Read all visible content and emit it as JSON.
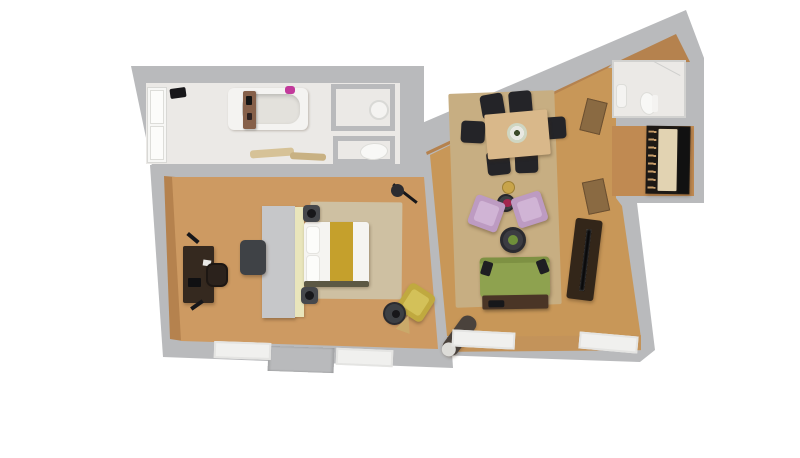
{
  "scene": {
    "kind": "3d-rendered-apartment-floor-plan",
    "background": "#ffffff"
  },
  "palette": {
    "wall": "#b9babc",
    "wall_light": "#c6c7c9",
    "marble": "#ebe9e6",
    "wood_bedroom": "#cd9a62",
    "wood_living": "#c89758",
    "wood_closet": "#c08a52",
    "wood_face": "#b5824e",
    "wood_face_light": "#c3935a",
    "rug_bedroom": "#cec0a2",
    "rug_living": "#c7ae82",
    "white_fixture": "#f4f3f1",
    "fixture_inner": "#e3e1dc",
    "caddy_wood": "#86604a",
    "flowers_pink": "#c23a9b",
    "flowers_red": "#a3264d",
    "towel": "#d6c297",
    "towel_dark": "#c8b183",
    "wardrobe_gray": "#c6c7c9",
    "headboard": "#e9e5bb",
    "mattress": "#f5f4f1",
    "pillow": "#fcfcfa",
    "runner_mustard": "#c5a02c",
    "bed_foot": "#5c5844",
    "nightstand": "#46484c",
    "lamp_black": "#17171a",
    "desk": "#35291f",
    "desk_chair": "#2b221c",
    "ottoman": "#3f4246",
    "armchair_yellow": "#c0a93f",
    "armchair_yellow_seat": "#d3c159",
    "side_table": "#3d4044",
    "cone_basket": "#caa96a",
    "dining_table": "#d9b88a",
    "dining_chair": "#242428",
    "armchair_pink": "#bd9bc2",
    "armchair_pink_seat": "#d0b4d5",
    "coffee_table": "#3c3c42",
    "plant": "#6f8f3a",
    "brass": "#c8a44a",
    "sofa_green": "#8ea24f",
    "sofa_back": "#7e9143",
    "sofa_base": "#4a3526",
    "pillow_dark": "#1e1e22",
    "tv_cabinet": "#332619",
    "tv_screen": "#0a0a0b",
    "rolled_rug": "#4a423c",
    "rolled_rug_end": "#dddcd8",
    "door_rattan": "#8a6a42",
    "closet_dark": "#1d1915",
    "closet_panel": "#e2d3b2",
    "window_frame": "#f6f6f5",
    "radiator": "#f0f0ee",
    "toilet": "#f8f8f6",
    "glass": "#cfcfcd"
  },
  "rooms": {
    "bathroom": {
      "floor": "marble-tile",
      "fixtures": [
        "double-door",
        "bathtub",
        "bath-caddy",
        "pink-flowers",
        "towels",
        "shower-stall",
        "toilet-stall"
      ]
    },
    "bedroom": {
      "floor": "oak-plank",
      "furniture": [
        "double-bed",
        "headboard-panel",
        "gray-wardrobe",
        "nightstand-lamps",
        "desk",
        "desk-chair",
        "ottoman",
        "area-rug",
        "yellow-armchair",
        "side-table",
        "floor-lamp",
        "windows-with-radiators"
      ]
    },
    "living_room": {
      "floor": "oak-plank",
      "furniture": [
        "dining-table",
        "six-dining-chairs",
        "flower-centerpiece",
        "area-rug",
        "two-pink-armchairs",
        "glass-flower-table",
        "brass-floor-lamp",
        "round-coffee-table-with-plant",
        "green-sofa",
        "media-cabinet",
        "rolled-rug",
        "rattan-doors",
        "windows-with-radiators"
      ]
    },
    "wc": {
      "floor": "marble-tile",
      "fixtures": [
        "toilet",
        "wash-basin",
        "glass-screen"
      ]
    },
    "closet": {
      "floor": "oak-plank",
      "furniture": [
        "dark-wardrobe",
        "cream-panel",
        "shelf-items"
      ]
    }
  }
}
